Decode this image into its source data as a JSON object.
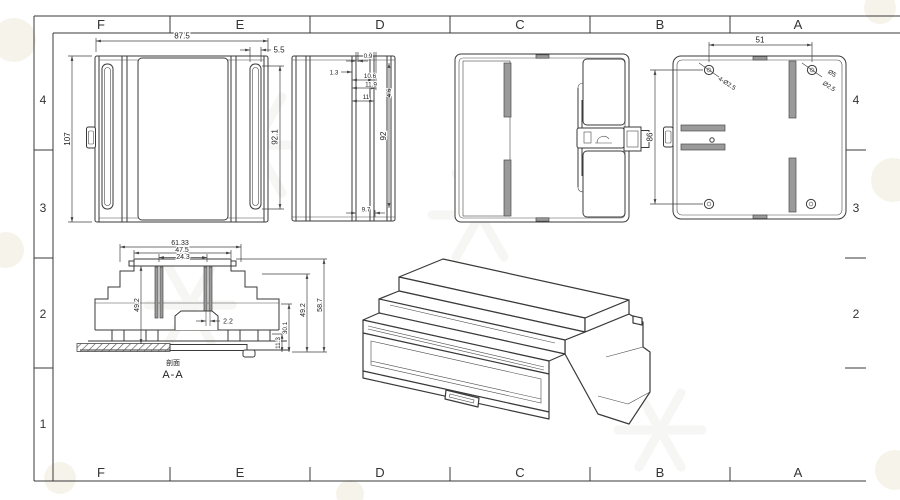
{
  "sheet": {
    "background": "#ffffff",
    "line_color": "#3a3a3a",
    "slot_fill_color": "#9a9a9a",
    "watermark_color": "#efe9d9",
    "grid": {
      "columns": [
        "F",
        "E",
        "D",
        "C",
        "B",
        "A"
      ],
      "rows_left": [
        "4",
        "3",
        "2",
        "1"
      ],
      "rows_right": [
        "4",
        "3",
        "2"
      ]
    }
  },
  "front_view": {
    "overall_width": "87.5",
    "overall_height": "107",
    "slot_width": "5.5",
    "slot_height": "92.1"
  },
  "side_view": {
    "d1": "0.9",
    "d2": "1.3",
    "d3": "10.6",
    "d4": "11.9",
    "d5": "4.6",
    "d6": "11",
    "panel_height": "92",
    "base_width": "9.7"
  },
  "top_view": {
    "hole_span": "51",
    "hole_span_vertical": "86",
    "callout_left": "4-Ø2.5",
    "callout_right_dia": "Ø5",
    "callout_right_dia2": "Ø2.5"
  },
  "section_view": {
    "caption_zh": "剖面",
    "caption": "A-A",
    "outer_width": "61.33",
    "inner_width": "47.5",
    "slot_span": "24.3",
    "left_height": "49.2",
    "slot_gap": "2.2",
    "h1": "11.3",
    "h2": "30.1",
    "h3": "49.2",
    "h4": "58.7"
  }
}
